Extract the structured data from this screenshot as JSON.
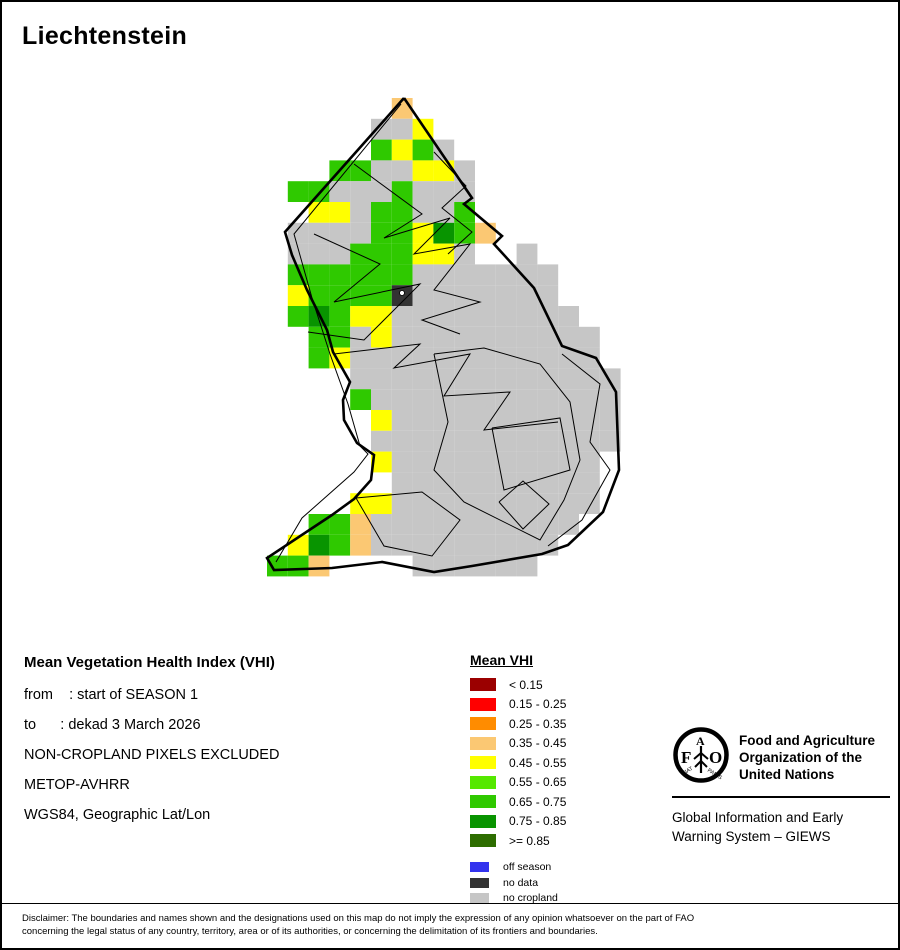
{
  "page": {
    "title": "Liechtenstein"
  },
  "info_block": {
    "heading": "Mean Vegetation Health Index (VHI)",
    "lines": [
      "from    : start of SEASON 1",
      "to      : dekad 3 March 2026",
      "NON-CROPLAND PIXELS EXCLUDED",
      "METOP-AVHRR",
      "WGS84, Geographic Lat/Lon"
    ]
  },
  "legend": {
    "title": "Mean VHI",
    "classes": [
      {
        "label": "< 0.15",
        "color": "#9B0000"
      },
      {
        "label": "0.15 - 0.25",
        "color": "#FF0000"
      },
      {
        "label": "0.25 - 0.35",
        "color": "#FF8C00"
      },
      {
        "label": "0.35 - 0.45",
        "color": "#FBC873"
      },
      {
        "label": "0.45 - 0.55",
        "color": "#FFFF00"
      },
      {
        "label": "0.55 - 0.65",
        "color": "#55E800"
      },
      {
        "label": "0.65 - 0.75",
        "color": "#2FC900"
      },
      {
        "label": "0.75 - 0.85",
        "color": "#089400"
      },
      {
        "label": ">= 0.85",
        "color": "#2D6D00"
      }
    ],
    "extra": [
      {
        "label": "off season",
        "color": "#3333EE"
      },
      {
        "label": "no data",
        "color": "#333333"
      },
      {
        "label": "no cropland",
        "color": "#C6C6C6"
      }
    ]
  },
  "fao": {
    "org_lines": [
      "Food and Agriculture",
      "Organization of the",
      "United Nations"
    ],
    "giews_lines": [
      "Global Information and Early",
      "Warning System – GIEWS"
    ],
    "emblem": {
      "letters": [
        "F",
        "A",
        "O"
      ],
      "motto_left": "FIAT",
      "motto_right": "PANIS"
    }
  },
  "disclaimer": {
    "lines": [
      "Disclaimer: The boundaries and names shown and the designations used on this map do not imply the expression of any opinion whatsoever on the part of FAO",
      "concerning the legal status of any country, territory, area or of its authorities, or concerning the delimitation of its frontiers and boundaries."
    ]
  },
  "map": {
    "grid": {
      "x0": 265,
      "y0": 96,
      "cell": 20.8
    },
    "palette": {
      "N": "#C6C6C6",
      "Y": "#FFFF00",
      "G": "#2FC900",
      "T": "#FBC873",
      "D": "#089400",
      "X": "#333333"
    },
    "palette_meaning": {
      "N": "no cropland",
      "Y": "VHI 0.45 - 0.55",
      "G": "VHI 0.65 - 0.75",
      "T": "VHI 0.35 - 0.45",
      "D": "VHI 0.75 - 0.85",
      "X": "no data"
    },
    "rows": [
      {
        "r": 0,
        "c0": 6,
        "p": "T"
      },
      {
        "r": 1,
        "c0": 5,
        "p": "NNY"
      },
      {
        "r": 2,
        "c0": 5,
        "p": "GYGN"
      },
      {
        "r": 3,
        "c0": 3,
        "p": "GGNNYYN"
      },
      {
        "r": 4,
        "c0": 1,
        "p": "GGNNNGNNN"
      },
      {
        "r": 5,
        "c0": 2,
        "p": "YYNGGNNG"
      },
      {
        "r": 6,
        "c0": 1,
        "p": "NNNNGGYDGT"
      },
      {
        "r": 7,
        "c0": 1,
        "p": "NNNGGGYYN..N"
      },
      {
        "r": 8,
        "c0": 1,
        "p": "GGGGGGNNNNNNN"
      },
      {
        "r": 9,
        "c0": 1,
        "p": "YGGGGXNNNNNNN"
      },
      {
        "r": 10,
        "c0": 1,
        "p": "GDGYYNNNNNNNNN"
      },
      {
        "r": 11,
        "c0": 2,
        "p": "GGNYNNNNNNNNNN"
      },
      {
        "r": 12,
        "c0": 2,
        "p": "GYNNNNNNNNNNNN"
      },
      {
        "r": 13,
        "c0": 4,
        "p": "NNNNNNNNNNNNN"
      },
      {
        "r": 14,
        "c0": 4,
        "p": "GNNNNNNNNNNNN"
      },
      {
        "r": 15,
        "c0": 5,
        "p": "YNNNNNNNNNNN"
      },
      {
        "r": 16,
        "c0": 5,
        "p": "NNNNNNNNNNNN"
      },
      {
        "r": 17,
        "c0": 5,
        "p": "YNNNNNNNNNN"
      },
      {
        "r": 18,
        "c0": 6,
        "p": "NNNNNNNNNN"
      },
      {
        "r": 19,
        "c0": 4,
        "p": "YYNNNNNNNNNN"
      },
      {
        "r": 20,
        "c0": 2,
        "p": "GGTNNNNNNNNNN"
      },
      {
        "r": 21,
        "c0": 1,
        "p": "YDGTNNNNNNNNN"
      },
      {
        "r": 22,
        "c0": 0,
        "p": "GGT....NNNNNN"
      }
    ],
    "no_data_marker": {
      "x": 400,
      "y": 291
    },
    "outer_boundary": [
      [
        402,
        96
      ],
      [
        470,
        196
      ],
      [
        462,
        202
      ],
      [
        500,
        234
      ],
      [
        492,
        242
      ],
      [
        532,
        286
      ],
      [
        560,
        344
      ],
      [
        594,
        356
      ],
      [
        614,
        390
      ],
      [
        617,
        468
      ],
      [
        601,
        510
      ],
      [
        566,
        543
      ],
      [
        540,
        552
      ],
      [
        470,
        564
      ],
      [
        432,
        570
      ],
      [
        380,
        560
      ],
      [
        330,
        566
      ],
      [
        272,
        568
      ],
      [
        265,
        556
      ],
      [
        330,
        513
      ],
      [
        352,
        497
      ],
      [
        369,
        478
      ],
      [
        372,
        453
      ],
      [
        355,
        441
      ],
      [
        342,
        418
      ],
      [
        341,
        398
      ],
      [
        348,
        380
      ],
      [
        331,
        350
      ],
      [
        325,
        328
      ],
      [
        305,
        288
      ],
      [
        290,
        253
      ],
      [
        283,
        230
      ],
      [
        402,
        96
      ]
    ],
    "inner_lines": [
      [
        [
          399,
          102
        ],
        [
          292,
          232
        ],
        [
          310,
          296
        ],
        [
          328,
          352
        ],
        [
          346,
          402
        ],
        [
          358,
          444
        ],
        [
          366,
          452
        ],
        [
          352,
          470
        ],
        [
          300,
          516
        ],
        [
          274,
          560
        ]
      ],
      [
        [
          352,
          162
        ],
        [
          420,
          212
        ],
        [
          382,
          236
        ],
        [
          448,
          216
        ],
        [
          412,
          252
        ],
        [
          468,
          242
        ],
        [
          432,
          288
        ],
        [
          478,
          300
        ],
        [
          420,
          318
        ],
        [
          458,
          332
        ]
      ],
      [
        [
          312,
          232
        ],
        [
          378,
          262
        ],
        [
          332,
          300
        ],
        [
          418,
          282
        ],
        [
          362,
          338
        ],
        [
          306,
          330
        ]
      ],
      [
        [
          332,
          352
        ],
        [
          418,
          342
        ],
        [
          392,
          366
        ],
        [
          468,
          352
        ],
        [
          442,
          394
        ],
        [
          508,
          390
        ],
        [
          482,
          428
        ],
        [
          556,
          420
        ]
      ],
      [
        [
          432,
          352
        ],
        [
          446,
          420
        ],
        [
          432,
          468
        ],
        [
          462,
          500
        ],
        [
          538,
          538
        ],
        [
          562,
          498
        ],
        [
          578,
          458
        ],
        [
          568,
          400
        ],
        [
          538,
          362
        ],
        [
          482,
          346
        ],
        [
          432,
          352
        ]
      ],
      [
        [
          490,
          426
        ],
        [
          558,
          416
        ],
        [
          568,
          468
        ],
        [
          502,
          488
        ],
        [
          490,
          426
        ]
      ],
      [
        [
          497,
          500
        ],
        [
          521,
          479
        ],
        [
          547,
          502
        ],
        [
          521,
          527
        ],
        [
          497,
          500
        ]
      ],
      [
        [
          560,
          352
        ],
        [
          598,
          382
        ],
        [
          588,
          440
        ],
        [
          608,
          468
        ],
        [
          580,
          518
        ],
        [
          546,
          544
        ]
      ],
      [
        [
          354,
          496
        ],
        [
          420,
          490
        ],
        [
          458,
          518
        ],
        [
          430,
          554
        ],
        [
          382,
          544
        ],
        [
          354,
          496
        ]
      ],
      [
        [
          432,
          150
        ],
        [
          464,
          184
        ],
        [
          440,
          206
        ],
        [
          470,
          230
        ],
        [
          446,
          252
        ]
      ]
    ]
  }
}
